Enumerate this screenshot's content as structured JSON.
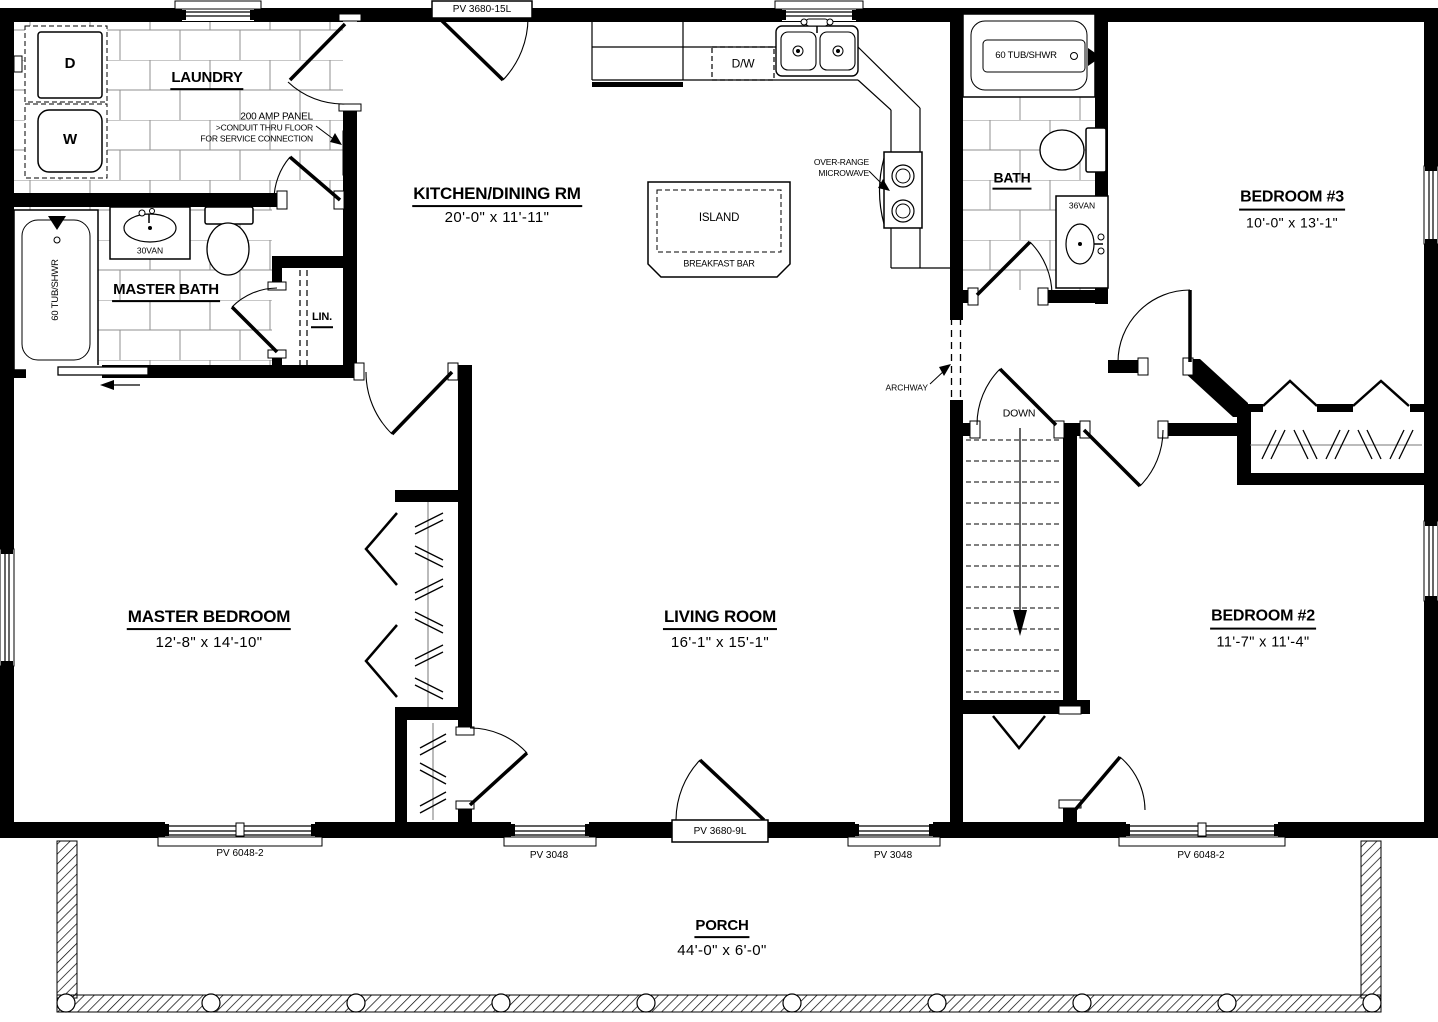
{
  "plan": {
    "rooms": {
      "laundry": {
        "name": "LAUNDRY"
      },
      "master_bath": {
        "name": "MASTER BATH"
      },
      "linen": {
        "name": "LIN."
      },
      "kitchen_dining": {
        "name": "KITCHEN/DINING RM",
        "size": "20'-0\" x 11'-11\""
      },
      "bath": {
        "name": "BATH"
      },
      "bedroom3": {
        "name": "BEDROOM #3",
        "size": "10'-0\" x 13'-1\""
      },
      "master_bedroom": {
        "name": "MASTER BEDROOM",
        "size": "12'-8\" x 14'-10\""
      },
      "living_room": {
        "name": "LIVING ROOM",
        "size": "16'-1\" x 15'-1\""
      },
      "bedroom2": {
        "name": "BEDROOM #2",
        "size": "11'-7\" x 11'-4\""
      },
      "porch": {
        "name": "PORCH",
        "size": "44'-0\" x 6'-0\""
      }
    },
    "fixtures": {
      "dryer": "D",
      "washer": "W",
      "dishwasher": "D/W",
      "island": "ISLAND",
      "breakfast_bar": "BREAKFAST BAR",
      "master_tub": "60 TUB/SHWR",
      "master_vanity": "30VAN",
      "hall_tub": "60 TUB/SHWR",
      "hall_vanity": "36VAN"
    },
    "annotations": {
      "electrical_panel": [
        "200 AMP PANEL",
        ">CONDUIT THRU FLOOR",
        "FOR SERVICE CONNECTION"
      ],
      "microwave": [
        "OVER-RANGE",
        "MICROWAVE"
      ],
      "archway": "ARCHWAY",
      "stairs_down": "DOWN"
    },
    "openings": {
      "kitchen_patio_door": "PV 3680-15L",
      "master_bedroom_window": "PV 6048-2",
      "living_window_left": "PV 3048",
      "front_door": "PV 3680-9L",
      "living_window_right": "PV 3048",
      "bedroom2_window": "PV 6048-2"
    },
    "colors": {
      "wall": "#000000",
      "tile_line": "#8f8f8f",
      "background": "#ffffff"
    }
  }
}
